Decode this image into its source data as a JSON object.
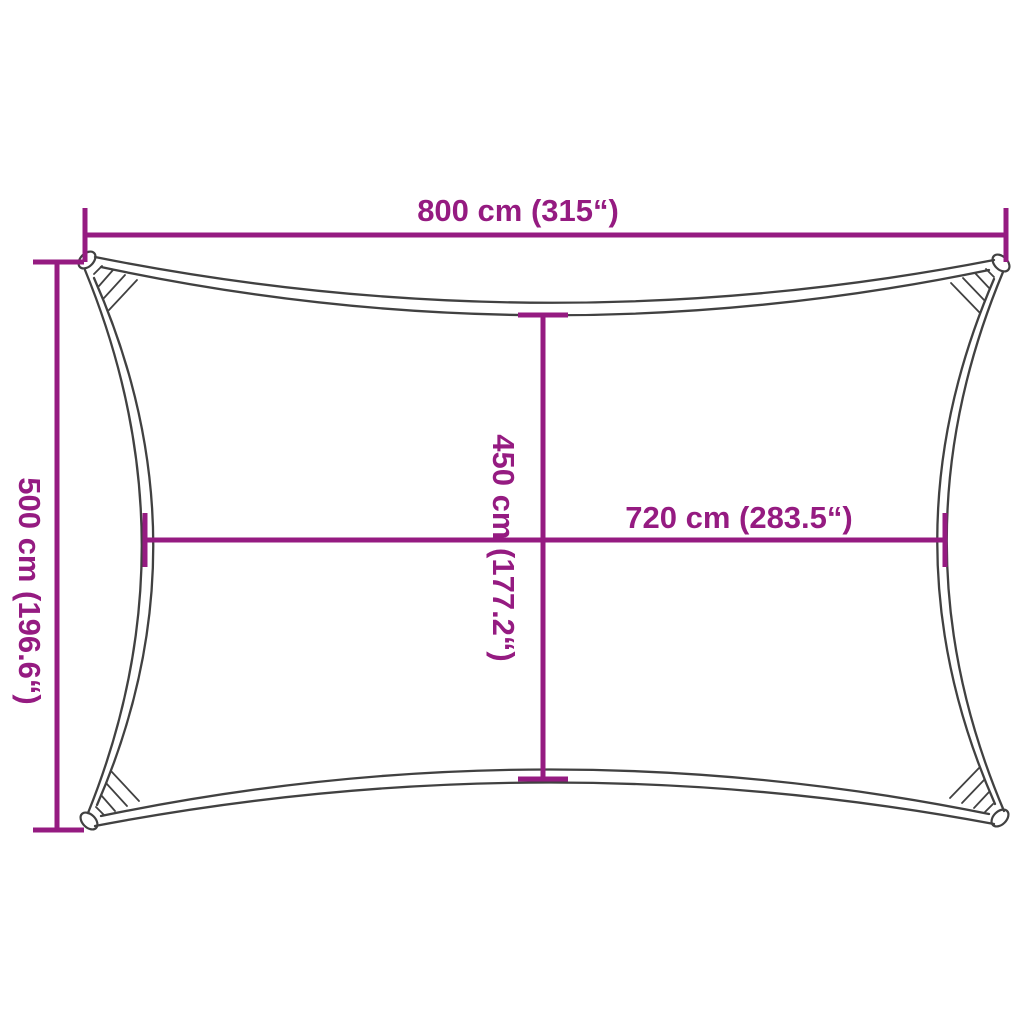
{
  "diagram": {
    "subject": "rectangular-shade-sail",
    "colors": {
      "accent": "#951b81",
      "outline": "#414141",
      "background": "#ffffff"
    },
    "dimensions": {
      "outer_width": {
        "label": "800 cm (315“)",
        "cm": 800,
        "inches": 315
      },
      "outer_height": {
        "label": "500 cm (196.6“)",
        "cm": 500,
        "inches": 196.6
      },
      "inner_height": {
        "label": "450 cm (177.2“)",
        "cm": 450,
        "inches": 177.2
      },
      "inner_width": {
        "label": "720 cm (283.5“)",
        "cm": 720,
        "inches": 283.5
      }
    }
  }
}
